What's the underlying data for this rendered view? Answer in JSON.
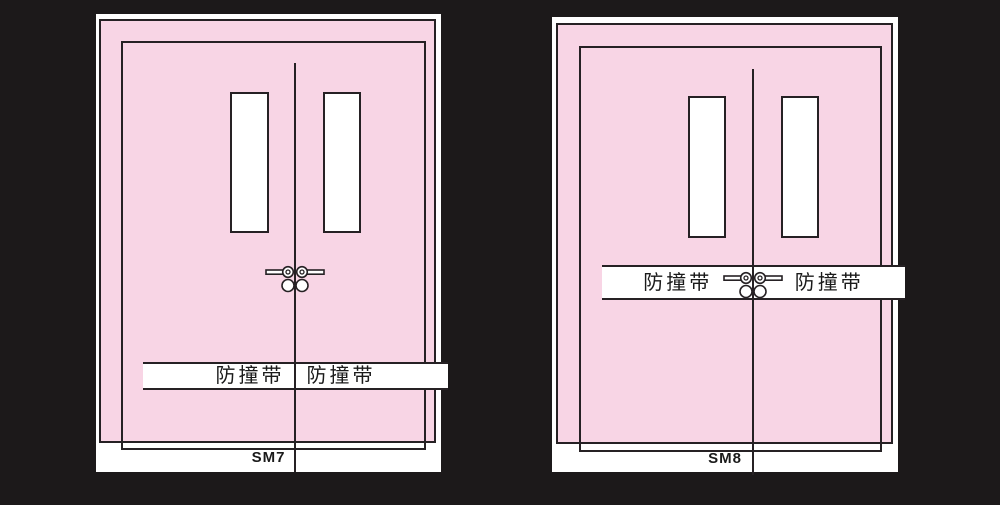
{
  "colors": {
    "background": "#1c191a",
    "door_fill": "#f8d5e5",
    "outline": "#262124",
    "panel_white": "#ffffff",
    "label_text": "#1a1a1a"
  },
  "doors": [
    {
      "label": "SM7",
      "band_labels": {
        "left": "防撞带",
        "right": "防撞带"
      }
    },
    {
      "label": "SM8",
      "band_labels": {
        "left": "防撞带",
        "right": "防撞带"
      }
    }
  ]
}
